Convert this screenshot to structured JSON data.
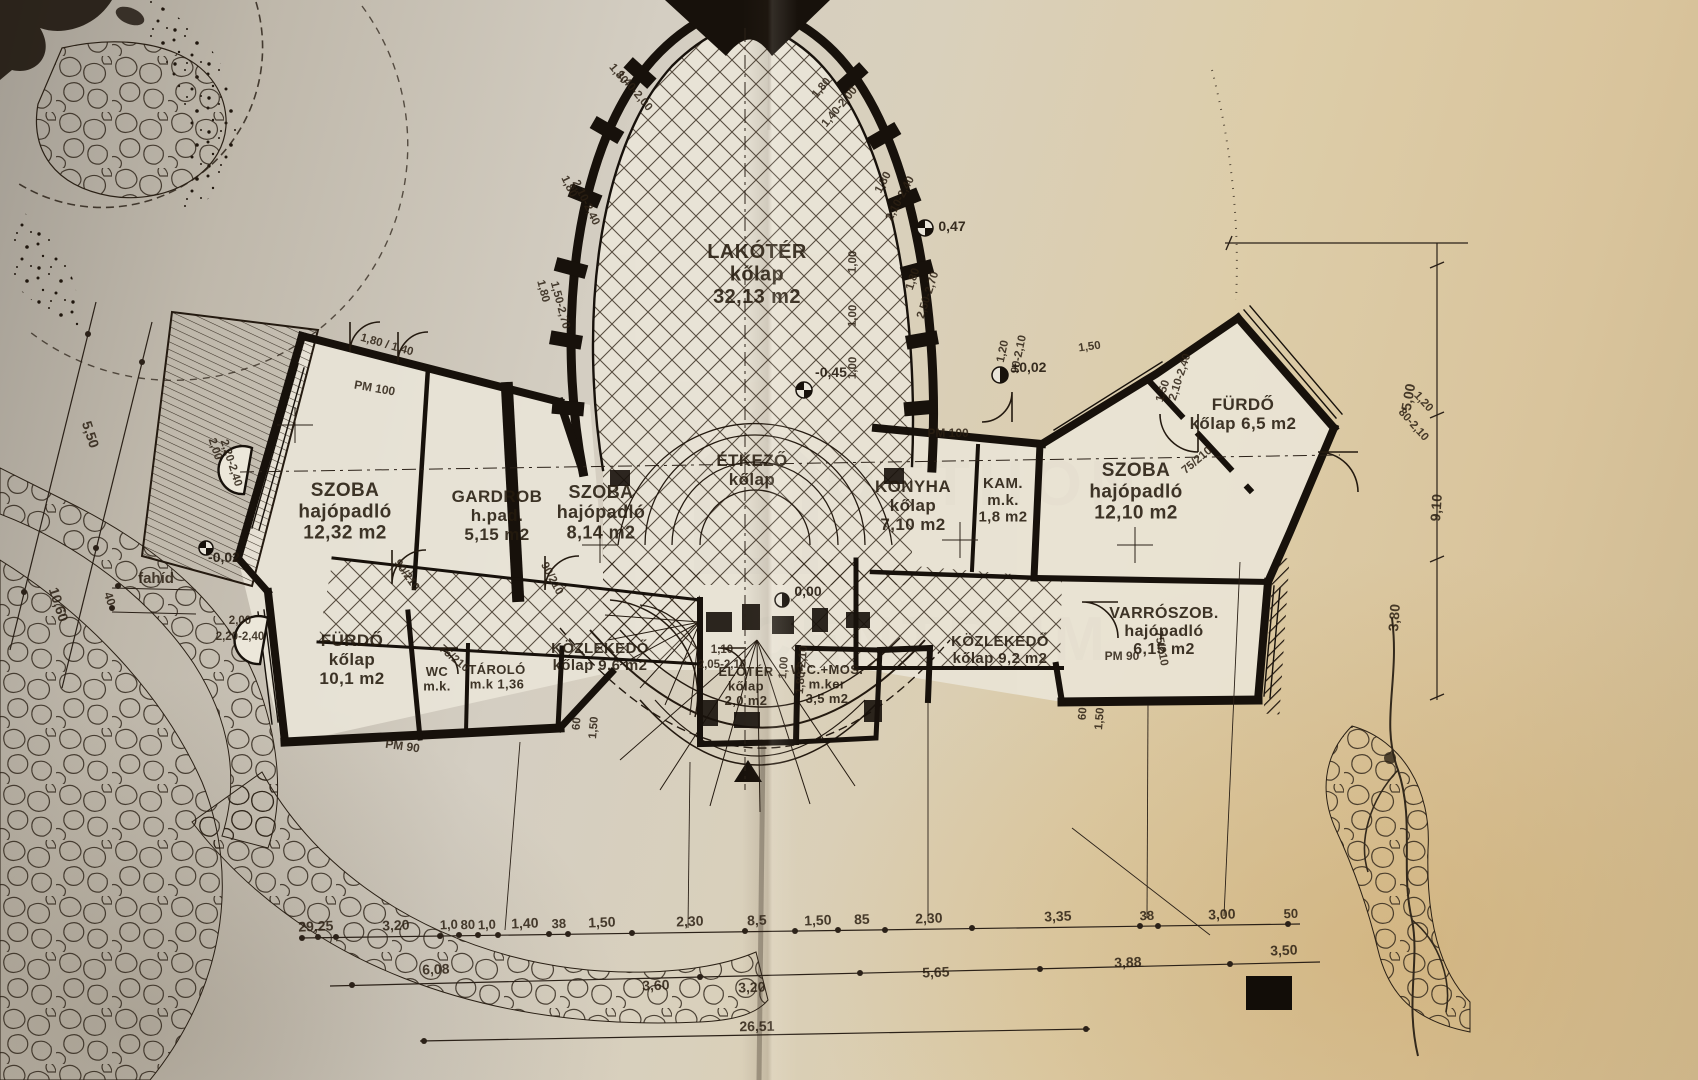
{
  "document": {
    "kind": "scanned architectural floor plan photo",
    "language": "Hungarian"
  },
  "watermark": {
    "line1": "OTTHON",
    "line2": "CENTRUM"
  },
  "rooms": [
    {
      "id": "lakoter",
      "lines": [
        "LAKÓTÉR",
        "kőlap",
        "32,13 m2"
      ],
      "x": 757,
      "y": 258,
      "fs": 20,
      "rot": -2
    },
    {
      "id": "szoba-left",
      "lines": [
        "SZOBA",
        "hajópadló",
        "12,32 m2"
      ],
      "x": 345,
      "y": 496,
      "fs": 19,
      "rot": 2
    },
    {
      "id": "gardrob",
      "lines": [
        "GARDROB",
        "h.pad.",
        "5,15 m2"
      ],
      "x": 497,
      "y": 502,
      "fs": 17,
      "rot": 2
    },
    {
      "id": "szoba-mid",
      "lines": [
        "SZOBA",
        "hajópadló",
        "8,14 m2"
      ],
      "x": 601,
      "y": 498,
      "fs": 18,
      "rot": 2
    },
    {
      "id": "etkezo",
      "lines": [
        "ÉTKEZŐ",
        "kőlap"
      ],
      "x": 752,
      "y": 466,
      "fs": 17,
      "rot": 0
    },
    {
      "id": "konyha",
      "lines": [
        "KONYHA",
        "kőlap",
        "7,10 m2"
      ],
      "x": 913,
      "y": 492,
      "fs": 17,
      "rot": 2
    },
    {
      "id": "kamra",
      "lines": [
        "KAM.",
        "m.k.",
        "1,8 m2"
      ],
      "x": 1003,
      "y": 488,
      "fs": 15,
      "rot": 0
    },
    {
      "id": "szoba-right",
      "lines": [
        "SZOBA",
        "hajópadló",
        "12,10 m2"
      ],
      "x": 1136,
      "y": 476,
      "fs": 19,
      "rot": -2
    },
    {
      "id": "furdo-topright",
      "lines": [
        "FÜRDŐ",
        "kőlap 6,5 m2"
      ],
      "x": 1243,
      "y": 410,
      "fs": 17,
      "rot": -2
    },
    {
      "id": "varroszoba",
      "lines": [
        "VARRÓSZOB.",
        "hajópadló",
        "6,15 m2"
      ],
      "x": 1164,
      "y": 618,
      "fs": 16,
      "rot": -2
    },
    {
      "id": "kozlekedo-left",
      "lines": [
        "KÖZLEKEDŐ",
        "kőlap 9,6 m2"
      ],
      "x": 600,
      "y": 653,
      "fs": 15,
      "rot": 1
    },
    {
      "id": "kozlekedo-right",
      "lines": [
        "KÖZLEKEDŐ",
        "kőlap 9,2 m2"
      ],
      "x": 1000,
      "y": 646,
      "fs": 15,
      "rot": 1
    },
    {
      "id": "furdo-bottomleft",
      "lines": [
        "FÜRDŐ",
        "kőlap",
        "10,1 m2"
      ],
      "x": 352,
      "y": 646,
      "fs": 17,
      "rot": 2
    },
    {
      "id": "wc",
      "lines": [
        "WC",
        "m.k."
      ],
      "x": 437,
      "y": 676,
      "fs": 13,
      "rot": 2
    },
    {
      "id": "tarolo",
      "lines": [
        "TÁROLÓ",
        "m.k 1,36"
      ],
      "x": 497,
      "y": 674,
      "fs": 13,
      "rot": 2
    },
    {
      "id": "eloter",
      "lines": [
        "ELŐTÉR",
        "kőlap",
        "2,0 m2"
      ],
      "x": 746,
      "y": 676,
      "fs": 13,
      "rot": 0
    },
    {
      "id": "wc-mosdo",
      "lines": [
        "W.C.+MOS.",
        "m.ker",
        "3,5 m2"
      ],
      "x": 827,
      "y": 674,
      "fs": 13,
      "rot": 0
    }
  ],
  "labels": [
    {
      "t": "fahíd",
      "x": 156,
      "y": 583,
      "r": 0,
      "fs": 15
    },
    {
      "t": "PM 100",
      "x": 374,
      "y": 392,
      "r": 10,
      "fs": 12
    },
    {
      "t": "PM 100",
      "x": 948,
      "y": 437,
      "r": 0,
      "fs": 12
    },
    {
      "t": "PM 90",
      "x": 1122,
      "y": 660,
      "r": 0,
      "fs": 12
    },
    {
      "t": "PM 90",
      "x": 402,
      "y": 750,
      "r": 8,
      "fs": 12
    }
  ],
  "elevation_marks": [
    {
      "t": "0,47",
      "x": 952,
      "y": 231
    },
    {
      "t": "±0,02",
      "x": 1029,
      "y": 372
    },
    {
      "t": "-0,45",
      "x": 831,
      "y": 377
    },
    {
      "t": "0,00",
      "x": 808,
      "y": 596
    },
    {
      "t": "-0,02",
      "x": 224,
      "y": 562
    }
  ],
  "dims": [
    {
      "t": "1,80",
      "x": 616,
      "y": 76,
      "r": 50
    },
    {
      "t": "1,40-2,00",
      "x": 632,
      "y": 93,
      "r": 50
    },
    {
      "t": "1,80",
      "x": 566,
      "y": 188,
      "r": 64
    },
    {
      "t": "2,10-2,40",
      "x": 583,
      "y": 204,
      "r": 64
    },
    {
      "t": "1,80",
      "x": 540,
      "y": 292,
      "r": 75
    },
    {
      "t": "1,50-2,70",
      "x": 557,
      "y": 306,
      "r": 75
    },
    {
      "t": "1,80",
      "x": 824,
      "y": 90,
      "r": -50
    },
    {
      "t": "1,40-2,00",
      "x": 842,
      "y": 109,
      "r": -50
    },
    {
      "t": "1,80",
      "x": 886,
      "y": 184,
      "r": -62
    },
    {
      "t": "2,10-2,40",
      "x": 903,
      "y": 200,
      "r": -62
    },
    {
      "t": "1,80",
      "x": 916,
      "y": 280,
      "r": -72
    },
    {
      "t": "2,50-2,70",
      "x": 931,
      "y": 296,
      "r": -72
    },
    {
      "t": "1,80 / 1,40",
      "x": 386,
      "y": 348,
      "r": 16
    },
    {
      "t": "2,00",
      "x": 212,
      "y": 450,
      "r": 72
    },
    {
      "t": "2,20-2,40",
      "x": 228,
      "y": 464,
      "r": 72
    },
    {
      "t": "2,00",
      "x": 240,
      "y": 624,
      "r": 0
    },
    {
      "t": "2,20-2,40",
      "x": 240,
      "y": 640,
      "r": 0
    },
    {
      "t": "90/210",
      "x": 404,
      "y": 577,
      "r": 55
    },
    {
      "t": "90/210",
      "x": 549,
      "y": 580,
      "r": 62
    },
    {
      "t": "75/210",
      "x": 452,
      "y": 661,
      "r": 40
    },
    {
      "t": "1,10",
      "x": 722,
      "y": 653,
      "r": 0
    },
    {
      "t": "2,05-2,10",
      "x": 722,
      "y": 668,
      "r": 0
    },
    {
      "t": "1,00",
      "x": 787,
      "y": 668,
      "r": -85
    },
    {
      "t": "1,80-2,10",
      "x": 805,
      "y": 670,
      "r": -85
    },
    {
      "t": "1,00",
      "x": 856,
      "y": 262,
      "r": -88
    },
    {
      "t": "1,00",
      "x": 856,
      "y": 316,
      "r": -88
    },
    {
      "t": "1,00",
      "x": 856,
      "y": 368,
      "r": -88
    },
    {
      "t": "1,20",
      "x": 1006,
      "y": 352,
      "r": -78
    },
    {
      "t": "90-2,10",
      "x": 1022,
      "y": 355,
      "r": -78
    },
    {
      "t": "1,50",
      "x": 1166,
      "y": 392,
      "r": -72
    },
    {
      "t": "2,10-2,40",
      "x": 1183,
      "y": 378,
      "r": -72
    },
    {
      "t": "75/210",
      "x": 1199,
      "y": 463,
      "r": -40
    },
    {
      "t": "1,20",
      "x": 1421,
      "y": 404,
      "r": 48
    },
    {
      "t": "80-2,10",
      "x": 1411,
      "y": 427,
      "r": 48
    },
    {
      "t": "75/210",
      "x": 1158,
      "y": 649,
      "r": 80
    },
    {
      "t": "60",
      "x": 1086,
      "y": 714,
      "r": -85
    },
    {
      "t": "1,50",
      "x": 1103,
      "y": 719,
      "r": -85
    },
    {
      "t": "60",
      "x": 580,
      "y": 724,
      "r": -85
    },
    {
      "t": "1,50",
      "x": 597,
      "y": 728,
      "r": -85
    },
    {
      "t": "1,50",
      "x": 1090,
      "y": 350,
      "r": -8
    },
    {
      "t": "5,50",
      "x": 86,
      "y": 436,
      "r": 72,
      "fs": 14
    },
    {
      "t": "10,60",
      "x": 54,
      "y": 606,
      "r": 72,
      "fs": 14
    },
    {
      "t": "40",
      "x": 106,
      "y": 600,
      "r": 72,
      "fs": 12
    },
    {
      "t": "5,00",
      "x": 1413,
      "y": 398,
      "r": -80,
      "fs": 14
    },
    {
      "t": "9,10",
      "x": 1441,
      "y": 508,
      "r": -86,
      "fs": 14
    },
    {
      "t": "3,80",
      "x": 1399,
      "y": 618,
      "r": -86,
      "fs": 14
    },
    {
      "t": "29,25",
      "x": 316,
      "y": 931,
      "r": -2,
      "fs": 14
    },
    {
      "t": "3,20",
      "x": 396,
      "y": 930,
      "r": -2,
      "fs": 14
    },
    {
      "t": "1,0",
      "x": 449,
      "y": 929,
      "r": -2,
      "fs": 13
    },
    {
      "t": "80",
      "x": 468,
      "y": 929,
      "r": -2,
      "fs": 13
    },
    {
      "t": "1,0",
      "x": 487,
      "y": 929,
      "r": -2,
      "fs": 13
    },
    {
      "t": "1,40",
      "x": 525,
      "y": 928,
      "r": -2,
      "fs": 14
    },
    {
      "t": "38",
      "x": 559,
      "y": 928,
      "r": -2,
      "fs": 13
    },
    {
      "t": "1,50",
      "x": 602,
      "y": 927,
      "r": -2,
      "fs": 14
    },
    {
      "t": "2,30",
      "x": 690,
      "y": 926,
      "r": -2,
      "fs": 14
    },
    {
      "t": "8,5",
      "x": 757,
      "y": 925,
      "r": -2,
      "fs": 14
    },
    {
      "t": "1,50",
      "x": 818,
      "y": 925,
      "r": -2,
      "fs": 14
    },
    {
      "t": "85",
      "x": 862,
      "y": 924,
      "r": -2,
      "fs": 14
    },
    {
      "t": "2,30",
      "x": 929,
      "y": 923,
      "r": -2,
      "fs": 14
    },
    {
      "t": "3,35",
      "x": 1058,
      "y": 921,
      "r": -2,
      "fs": 14
    },
    {
      "t": "38",
      "x": 1147,
      "y": 920,
      "r": -2,
      "fs": 13
    },
    {
      "t": "3,00",
      "x": 1222,
      "y": 919,
      "r": -2,
      "fs": 14
    },
    {
      "t": "50",
      "x": 1291,
      "y": 918,
      "r": -2,
      "fs": 13
    },
    {
      "t": "6,08",
      "x": 436,
      "y": 974,
      "r": -2,
      "fs": 14
    },
    {
      "t": "3,60",
      "x": 656,
      "y": 990,
      "r": -2,
      "fs": 14
    },
    {
      "t": "3,20",
      "x": 752,
      "y": 992,
      "r": -2,
      "fs": 14
    },
    {
      "t": "5,65",
      "x": 936,
      "y": 977,
      "r": -2,
      "fs": 14
    },
    {
      "t": "3,88",
      "x": 1128,
      "y": 967,
      "r": -2,
      "fs": 14
    },
    {
      "t": "3,50",
      "x": 1284,
      "y": 955,
      "r": -2,
      "fs": 14
    },
    {
      "t": "26,51",
      "x": 757,
      "y": 1031,
      "r": -1,
      "fs": 14
    }
  ]
}
